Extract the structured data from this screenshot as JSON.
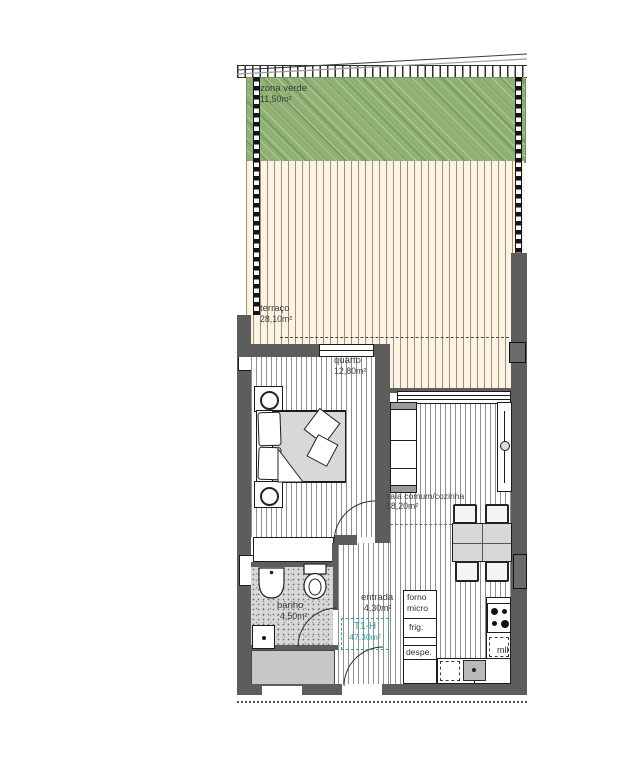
{
  "plan": {
    "unit": {
      "code": "T1-H",
      "total_area": "47,30m²"
    },
    "rooms": {
      "zona_verde": {
        "name": "zona verde",
        "area": "11,50m²"
      },
      "terraco": {
        "name": "terraço",
        "area": "28,10m²"
      },
      "quarto": {
        "name": "quarto",
        "area": "12,80m²"
      },
      "sala": {
        "name": "sala comum/cozinha",
        "area": "18,20m²"
      },
      "banho": {
        "name": "banho",
        "area": "4,50m²"
      },
      "entrada": {
        "name": "entrada",
        "area": "4,30m²"
      }
    },
    "kitchen": {
      "forno": "forno",
      "micro": "micro",
      "frigorifico": "frig.",
      "despensa": "despe.",
      "maquina_lavar_louca": "mll"
    },
    "colors": {
      "wall": "#5d5d5d",
      "green_zone": "#8fb173",
      "terrace_bg": "#faf3e6",
      "floor_line": "#8f8f8f",
      "unit_accent": "#2ba3a6",
      "text": "#3d3d3d"
    }
  }
}
